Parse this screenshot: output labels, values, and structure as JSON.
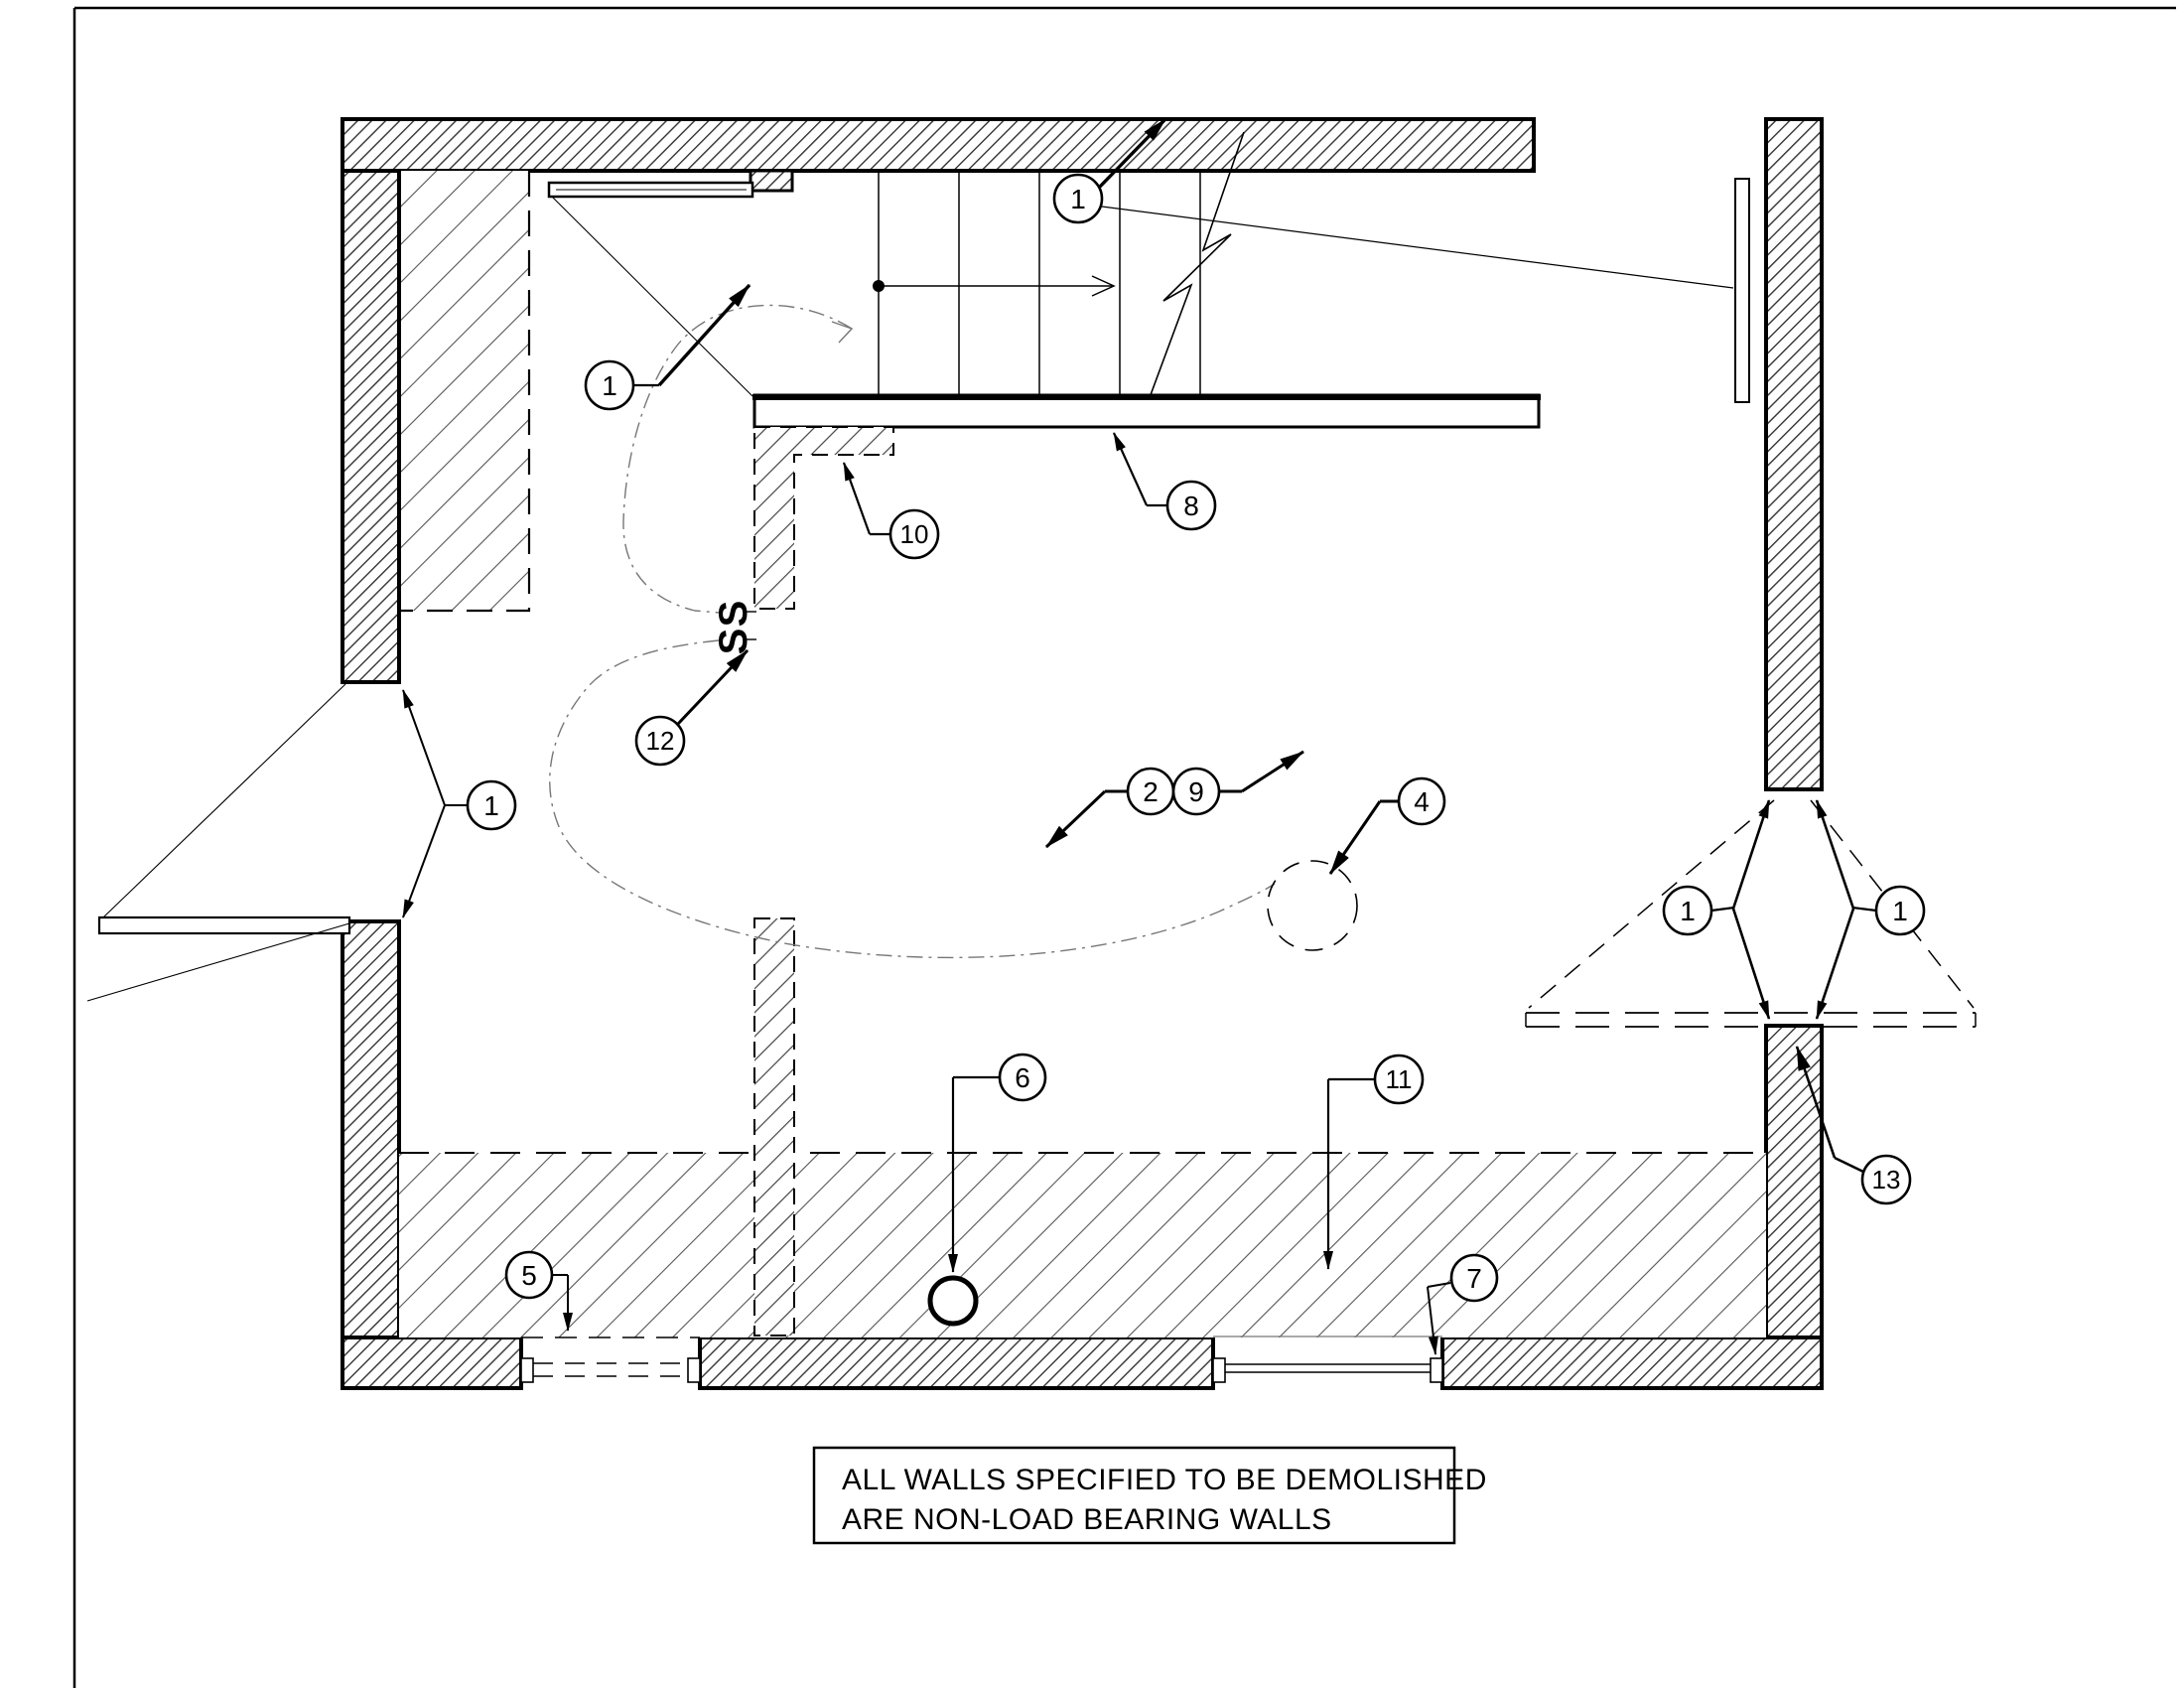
{
  "note_box": {
    "line1": "ALL WALLS SPECIFIED TO BE DEMOLISHED",
    "line2": "ARE NON-LOAD BEARING WALLS"
  },
  "stair_annotation": {
    "ss_upper": "S",
    "ss_lower": "S"
  },
  "callouts": {
    "stair_area": "1",
    "top_right": "1",
    "left_door": "1",
    "right_door_left": "1",
    "right_door_right": "1",
    "n2": "2",
    "n4": "4",
    "n5": "5",
    "n6": "6",
    "n7": "7",
    "n8": "8",
    "n9": "9",
    "n10": "10",
    "n11": "11",
    "n12": "12",
    "n13": "13"
  },
  "colors": {
    "ink": "#000000",
    "paper": "#ffffff",
    "hatch": "#333333",
    "demo_hatch": "#555555",
    "dash_curve": "#777777"
  }
}
